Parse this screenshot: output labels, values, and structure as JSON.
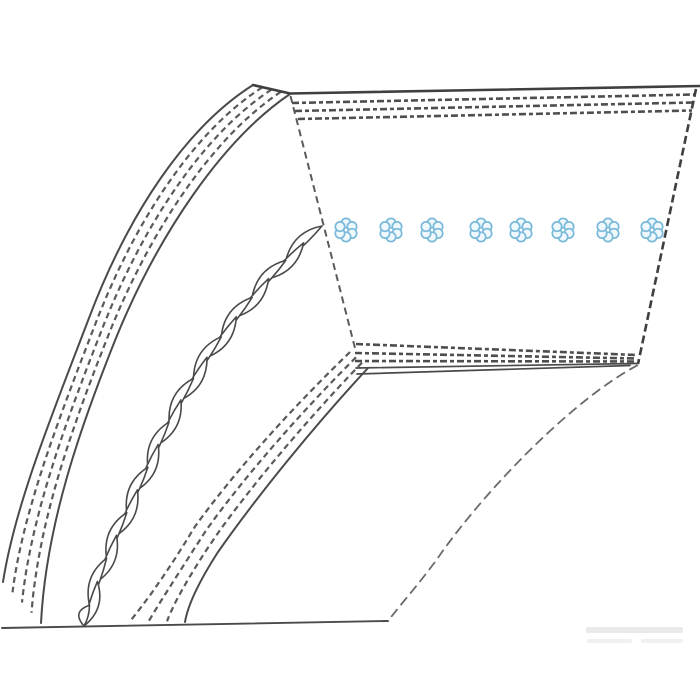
{
  "meta": {
    "title": "V-belt technical line illustration",
    "description": "Monochrome catalog drawing of a trapezoidal V-belt: curved belt body with fabric-ply dashed bands, a twisted tension cord shown in cut-away, and a flat face with eight light-blue cord-bundle cross sections."
  },
  "canvas": {
    "width": 700,
    "height": 700,
    "background": "#ffffff"
  },
  "palette": {
    "line": "#4a4a4a",
    "line_dark": "#3f3f3f",
    "line_soft": "#5a5a5a",
    "line_faint": "#6a6a6a",
    "cord_stroke": "#79b9d9",
    "cord_fill": "#eef8fd",
    "watermark": "#e9e9e9",
    "watermark_faint": "#f1f1f1"
  },
  "belt_face": {
    "top_edge": "M 253 85 L 290 93.5 L 700 86",
    "left_edge": "M 290.5 96 L 355 348",
    "right_edge": "M 696 89 L 638 364",
    "bottom_edges": [
      "M 356 368 L 637 363.5",
      "M 357 374 L 630 365.5"
    ],
    "top_ply_rows": [
      "M 292 103 L 695 94.5",
      "M 295 111 L 693 102.5",
      "M 298 119 L 692 110.5"
    ],
    "bottom_ply_rows": [
      "M 356 344 L 637 355",
      "M 355 353 L 636 358.5",
      "M 355 361 L 634 361.5"
    ]
  },
  "curved_body": {
    "outer_band": {
      "outer_edge": "M 253 85 C 185 128 128 215 89 318 C 52 415 15 505 3 582",
      "inner_edge": "M 290 94 C 222 140 158 235 116 338 C 80 428 46 525 41 623",
      "ply_fractions": [
        0.25,
        0.5,
        0.75
      ],
      "outer_edge_solid": true,
      "inner_edge_solid": true
    },
    "inner_band": {
      "outer_edge": "M 350 352 C 292 408 234 472 194 528 C 175 560 150 597 131 620",
      "inner_edge": "M 368 368 C 315 425 258 495 218 552 C 200 580 188 604 185 622",
      "ply_fractions": [
        0,
        0.333,
        0.667
      ],
      "outer_edge_solid": false,
      "inner_edge_solid": true
    }
  },
  "twisted_cord": {
    "centerline": "M 322 226 C 252 288 196 362 158 445 C 128 512 96 572 84 626",
    "segment_length": 50,
    "half_width": 16
  },
  "cord_bundles": {
    "y_center": 230,
    "x_centers": [
      346,
      391,
      432,
      481,
      521,
      563,
      608,
      652
    ],
    "ring_radius": 6.9,
    "circle_radius": 4.7,
    "circles_per_bundle": 6
  },
  "ground_line": "M 2 628 L 388 621",
  "sweep_curve": "M 638 365 C 575 398 490 485 442 552 C 425 577 400 605 388 621",
  "watermark": {
    "bars": [
      {
        "x": 586,
        "y": 627,
        "w": 97,
        "h": 6
      },
      {
        "x": 587,
        "y": 639,
        "w": 45,
        "h": 4
      },
      {
        "x": 641,
        "y": 639,
        "w": 42,
        "h": 4
      }
    ]
  }
}
